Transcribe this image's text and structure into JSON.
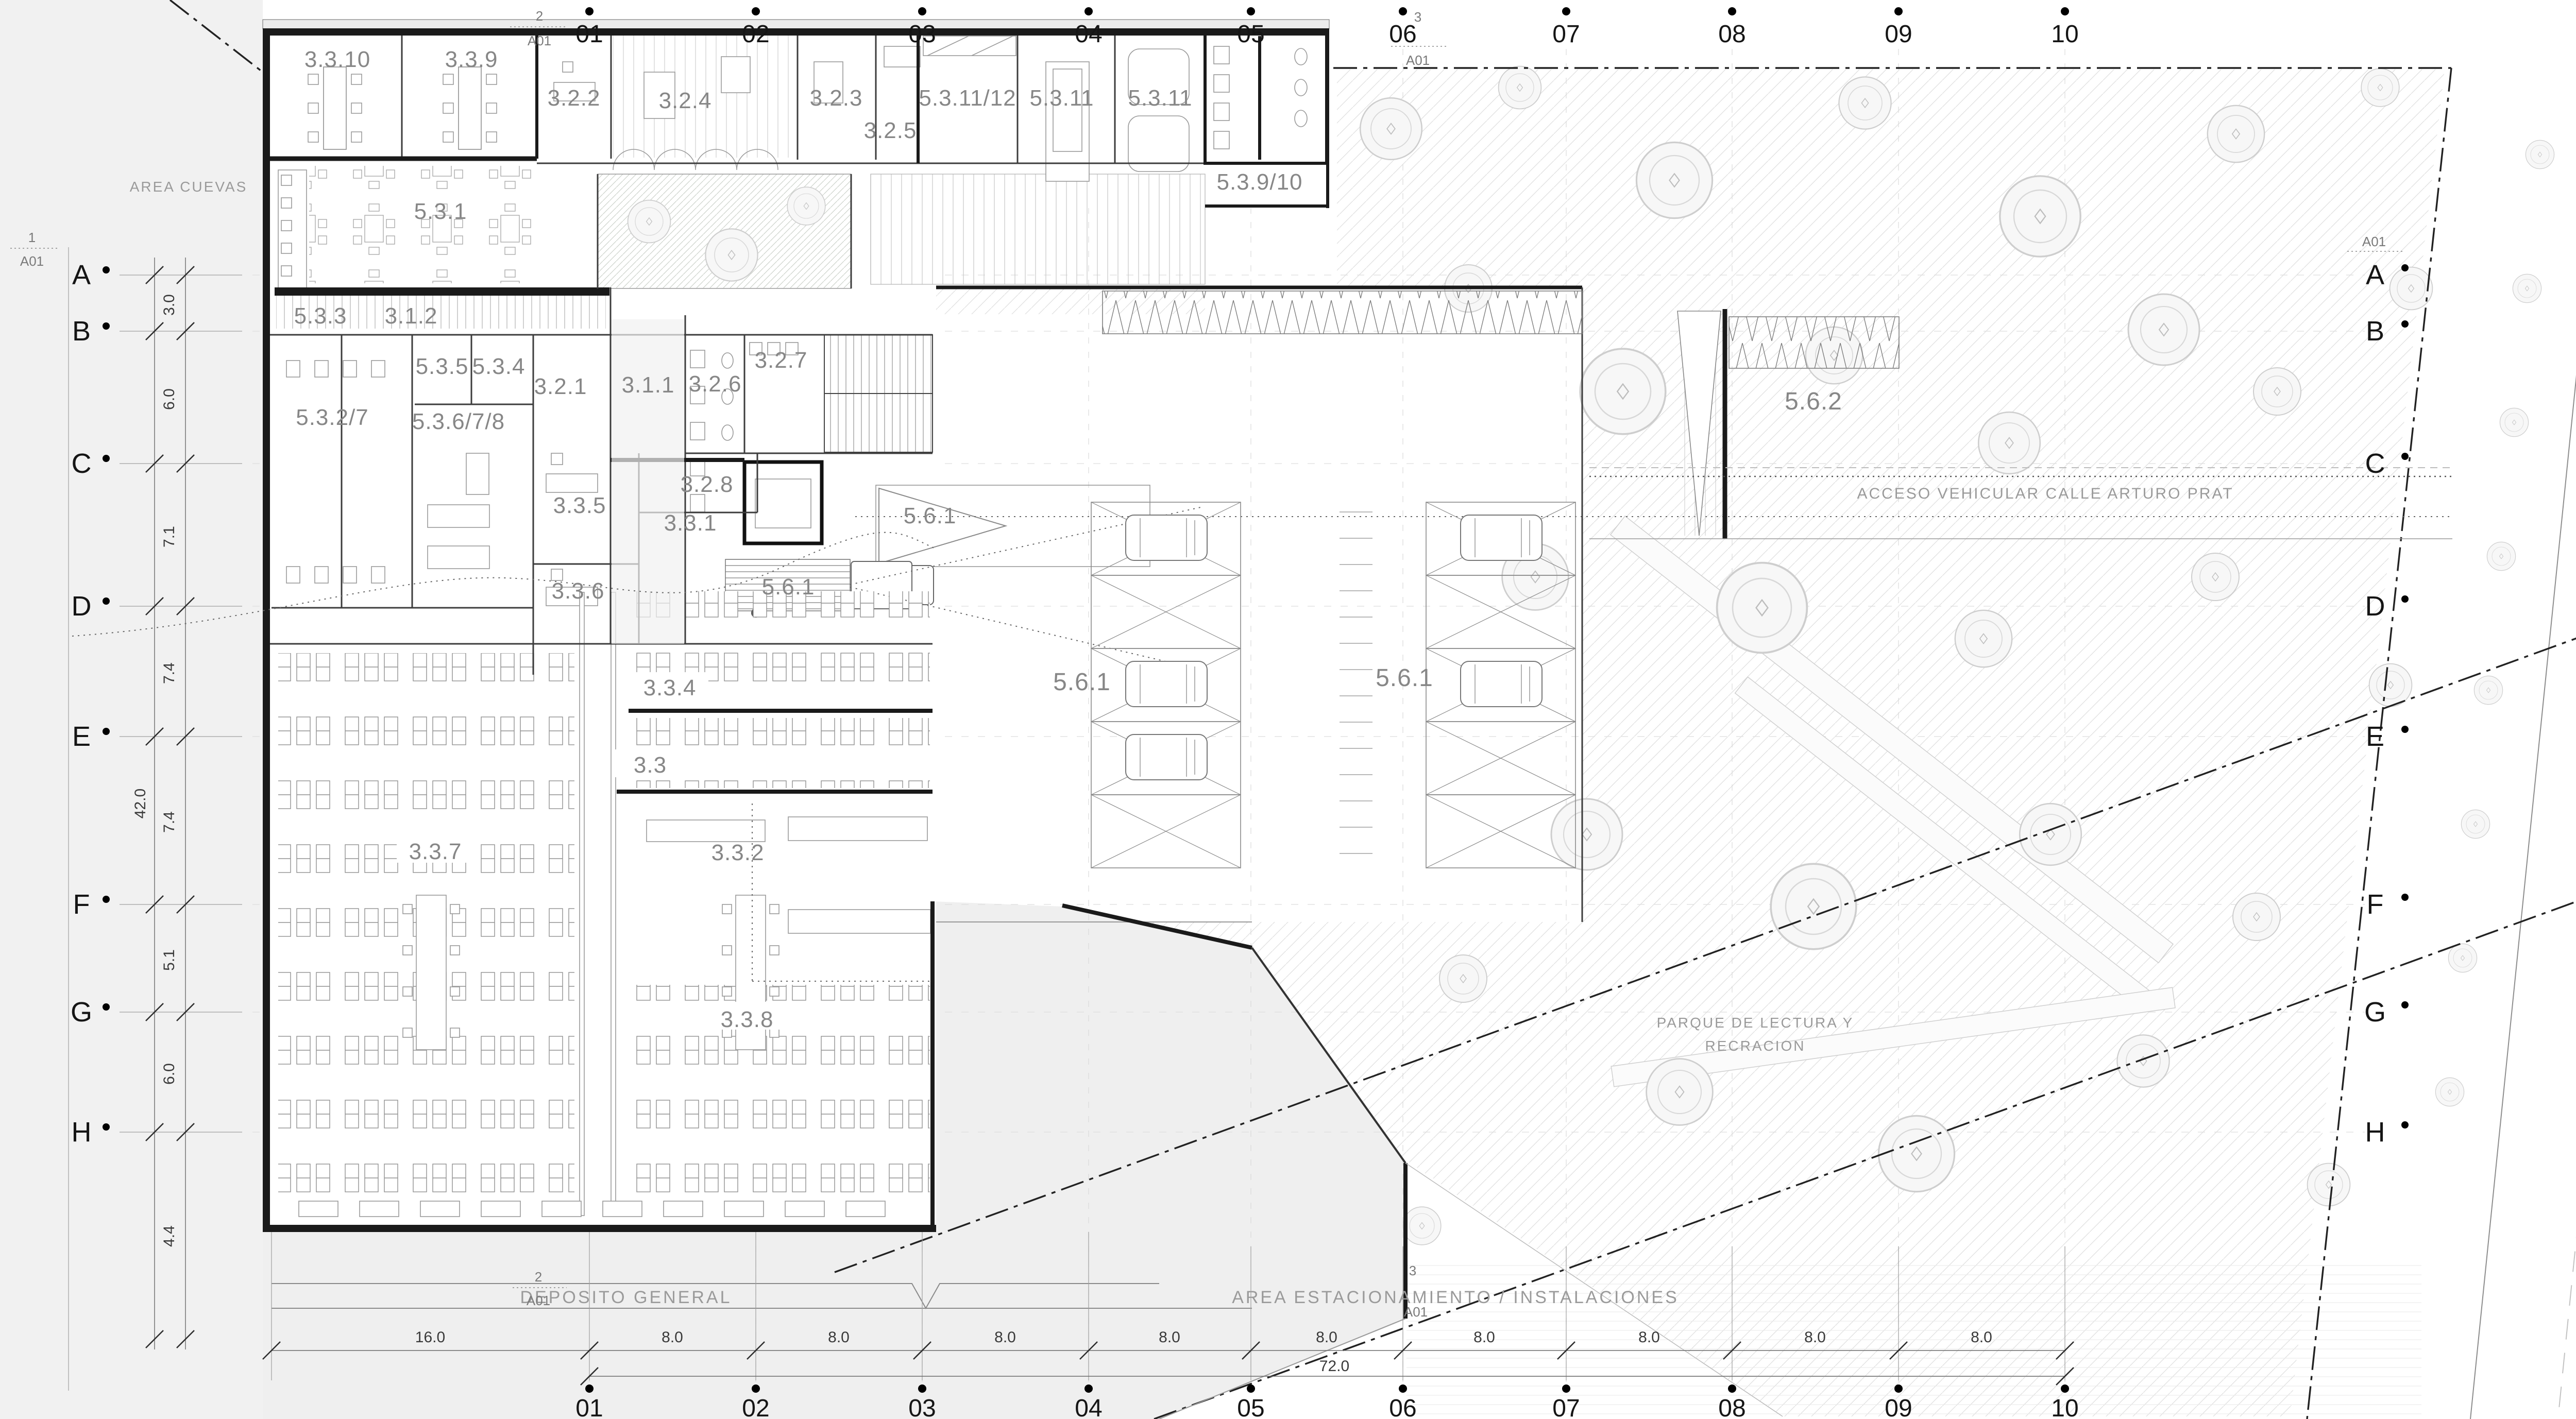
{
  "title": "Planta nivel - biblioteca y estacionamientos",
  "colors": {
    "water": "#b9c9d1",
    "site": "#f1f1f1",
    "plaza": "#efefef",
    "wall": "#1a1a1a",
    "label": "#878787"
  },
  "site": {
    "area_cuevas": "AREA CUEVAS",
    "rio": "RIO CALLE CALLE",
    "calle": "CALLE ARTURO PRAT",
    "acceso": "ACCESO VEHICULAR CALLE ARTURO PRAT",
    "parque_line1": "PARQUE DE LECTURA Y",
    "parque_line2": "RECRACION",
    "deposito": "DEPOSITO GENERAL",
    "estacionamiento": "AREA ESTACIONAMIENTO / INSTALACIONES"
  },
  "markers": {
    "m1": "1",
    "m2": "2",
    "m3": "3",
    "sheet": "A01"
  },
  "grid": {
    "cols": [
      "01",
      "02",
      "03",
      "04",
      "05",
      "06",
      "07",
      "08",
      "09",
      "10"
    ],
    "rows": [
      "A",
      "B",
      "C",
      "D",
      "E",
      "F",
      "G",
      "H"
    ]
  },
  "dims": {
    "left": [
      "3.0",
      "6.0",
      "7.1",
      "7.4",
      "7.4",
      "5.1",
      "6.0",
      "4.4"
    ],
    "left_total": "42.0",
    "bottom": [
      "16.0",
      "8.0",
      "8.0",
      "8.0",
      "8.0",
      "8.0",
      "8.0",
      "8.0",
      "8.0",
      "8.0"
    ],
    "bottom_total": "72.0"
  },
  "rooms": [
    {
      "label": "3.3.10"
    },
    {
      "label": "3.3.9"
    },
    {
      "label": "3.2.2"
    },
    {
      "label": "3.2.4"
    },
    {
      "label": "3.2.3"
    },
    {
      "label": "3.2.5"
    },
    {
      "label": "5.3.11/12"
    },
    {
      "label": "5.3.11"
    },
    {
      "label": "5.3.11"
    },
    {
      "label": "5.3.9/10"
    },
    {
      "label": "5.3.1"
    },
    {
      "label": "5.3.3"
    },
    {
      "label": "3.1.2"
    },
    {
      "label": "5.3.5"
    },
    {
      "label": "5.3.4"
    },
    {
      "label": "5.3.2/7"
    },
    {
      "label": "5.3.6/7/8"
    },
    {
      "label": "3.2.1"
    },
    {
      "label": "3.1.1"
    },
    {
      "label": "3.2.6"
    },
    {
      "label": "3.2.7"
    },
    {
      "label": "3.2.8"
    },
    {
      "label": "3.3.5"
    },
    {
      "label": "3.3.1"
    },
    {
      "label": "3.3.6"
    },
    {
      "label": "5.6.1"
    },
    {
      "label": "5.6.1"
    },
    {
      "label": "3.3.4"
    },
    {
      "label": "3.3"
    },
    {
      "label": "3.3.2"
    },
    {
      "label": "3.3.7"
    },
    {
      "label": "3.3.8"
    },
    {
      "label": "5.6.1"
    },
    {
      "label": "5.6.1"
    },
    {
      "label": "5.6.2"
    }
  ]
}
